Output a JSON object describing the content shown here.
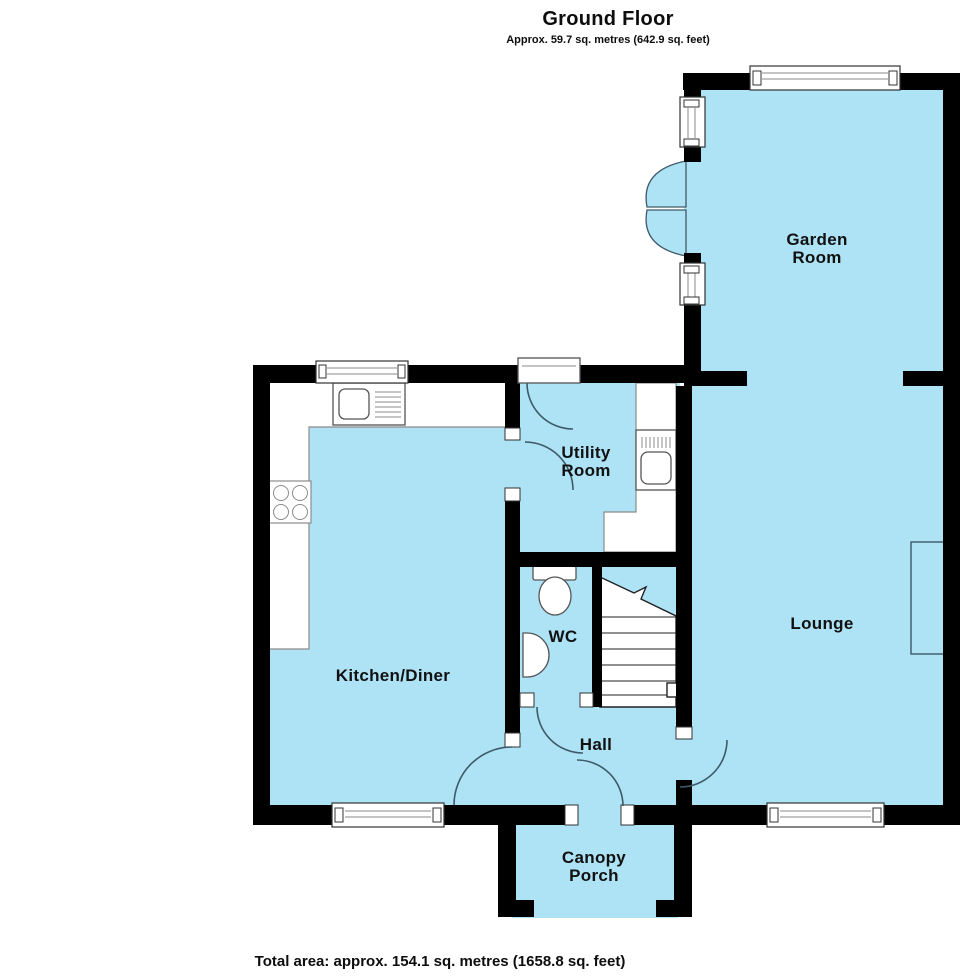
{
  "header": {
    "title": "Ground Floor",
    "subtitle": "Approx. 59.7 sq. metres (642.9 sq. feet)"
  },
  "rooms": {
    "garden_room": {
      "label": "Garden\nRoom"
    },
    "utility_room": {
      "label": "Utility\nRoom"
    },
    "kitchen_diner": {
      "label": "Kitchen/Diner"
    },
    "wc": {
      "label": "WC"
    },
    "hall": {
      "label": "Hall"
    },
    "lounge": {
      "label": "Lounge"
    },
    "canopy_porch": {
      "label": "Canopy\nPorch"
    }
  },
  "footer": {
    "total_area": "Total area: approx. 154.1 sq. metres (1658.8 sq. feet)"
  },
  "colors": {
    "room_fill": "#aee2f5",
    "wall": "#000000",
    "door_arc": "#3e5a68",
    "window_frame": "#333333",
    "fixture_outline": "#555555"
  }
}
